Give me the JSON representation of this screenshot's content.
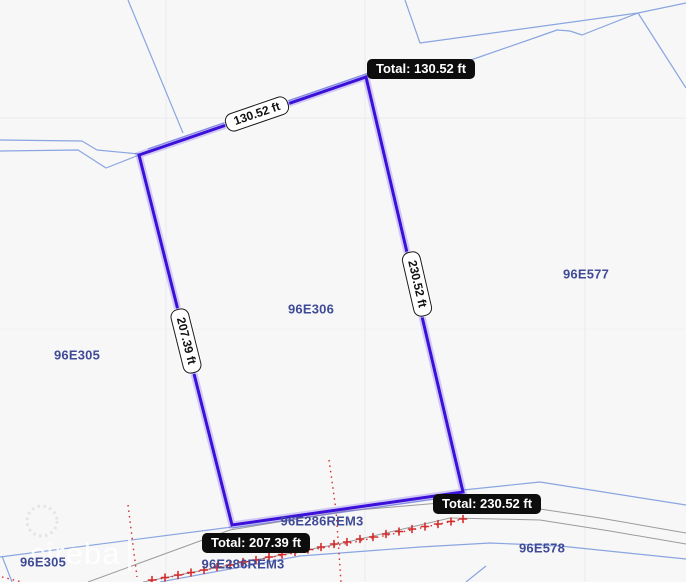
{
  "map": {
    "watermark": "cireba",
    "parcels": [
      {
        "label": "96E306"
      },
      {
        "label": "96E577"
      },
      {
        "label": "96E305"
      },
      {
        "label": "96E286REM3"
      },
      {
        "label": "96E286REM3"
      },
      {
        "label": "96E305"
      },
      {
        "label": "96E578"
      }
    ],
    "measurement": {
      "totals": [
        {
          "label": "Total: 130.52 ft"
        },
        {
          "label": "Total: 230.52 ft"
        },
        {
          "label": "Total: 207.39 ft"
        }
      ],
      "edges": [
        {
          "label": "130.52 ft"
        },
        {
          "label": "207.39 ft"
        },
        {
          "label": "230.52 ft"
        }
      ]
    },
    "colors": {
      "selected_parcel_outline": "#3b10d8",
      "boundary_line": "#8aa5e0",
      "road_line": "#9b9b9b",
      "survey_marks": "#d42b2b",
      "parcel_label": "#3f4b96",
      "tooltip_bg": "#0d0d0d",
      "tooltip_text": "#ffffff",
      "measure_pill_bg": "#ffffff"
    }
  }
}
